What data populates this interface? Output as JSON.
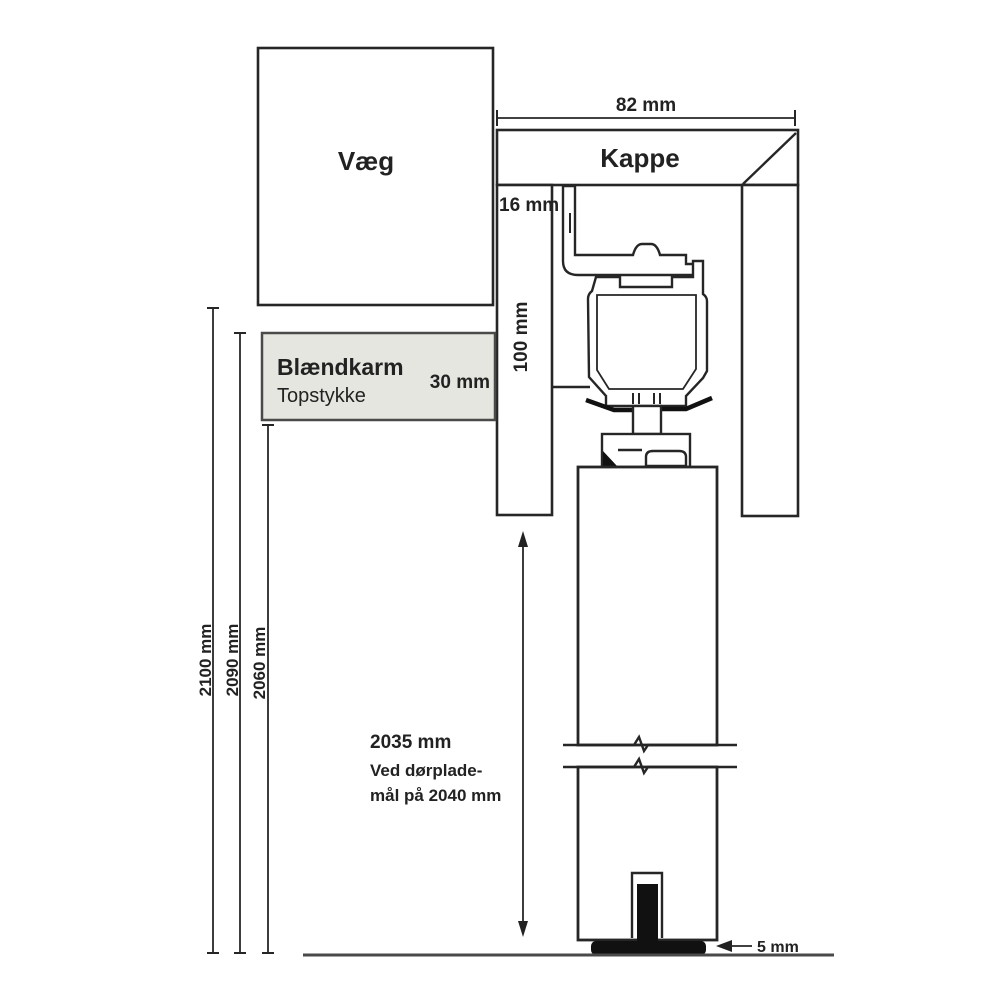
{
  "diagram": {
    "background": "#ffffff",
    "line_color": "#262626",
    "floor_line_color": "#4a4a4a",
    "guide_fill": "#111111",
    "wall": {
      "label": "Væg"
    },
    "cover": {
      "label": "Kappe"
    },
    "frame": {
      "label_line1": "Blændkarm",
      "label_line2": "Topstykke",
      "thickness_label": "30 mm",
      "fill": "#e6e6e0",
      "border": "#4a4a4a"
    },
    "dimensions": {
      "cover_width": "82 mm",
      "cover_leg_thickness": "16 mm",
      "cover_leg_length": "100 mm",
      "total_height": "2100 mm",
      "frame_top_height": "2090 mm",
      "frame_underside_height": "2060 mm",
      "door_height_line1": "2035 mm",
      "door_height_line2": "Ved dørplade-",
      "door_height_line3": "mål på 2040 mm",
      "floor_gap": "5 mm"
    }
  }
}
